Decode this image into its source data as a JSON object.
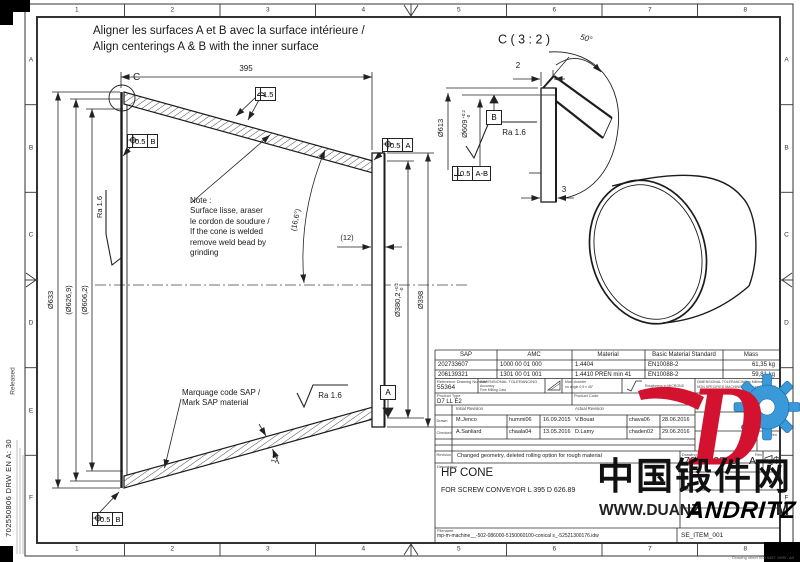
{
  "sheet": {
    "cols": [
      "1",
      "2",
      "3",
      "4",
      "5",
      "6",
      "7",
      "8"
    ],
    "rows": [
      "A",
      "B",
      "C",
      "D",
      "E",
      "F"
    ],
    "released": "Released",
    "margin_id": "702550806 DRW EN A: 30",
    "std_note": "Drawing sheet ISO 5457 1999 - A3"
  },
  "instruction": {
    "line1": "Aligner les surfaces A et B avec la surface intérieure /",
    "line2": "Align centerings A & B with the inner surface"
  },
  "main_view": {
    "length": "395",
    "detail_mark": "C",
    "dia_outer": "Ø633",
    "dia_mid": "(Ø626,9)",
    "dia_inner": "(Ø606,2)",
    "dia_small": "Ø380,2",
    "dia_small_tol_up": "+0.2",
    "dia_small_tol_dn": "-0",
    "dia_small_outer": "Ø398",
    "wall": "(12)",
    "wall_thk": "12",
    "angle": "(16,6°)",
    "ra": "Ra 1.6",
    "profile_tol": "1.5",
    "pos_tol_b": "0.5",
    "datum_b": "B",
    "pos_tol_a": "0.5",
    "datum_a": "A",
    "note": [
      "Note :",
      "Surface lisse, araser",
      "le cordon de soudure /",
      "If the cone is welded",
      "remove weld bead by",
      "grinding"
    ],
    "mark": [
      "Marquage code SAP /",
      "Mark SAP material"
    ]
  },
  "detail_view": {
    "title": "C ( 3 : 2 )",
    "angle": "50°",
    "chamfer": "2",
    "thk": "3",
    "dia1": "Ø613",
    "dia2": "Ø609",
    "dia2_tol_up": "+0.2",
    "dia2_tol_dn": "-0",
    "ra": "Ra 1.6",
    "datum": "B",
    "perp_tol": "0.5",
    "perp_datum": "A-B"
  },
  "title_block": {
    "headers": [
      "SAP",
      "AMC",
      "Material",
      "Basic Material Standard",
      "Mass"
    ],
    "rows": [
      {
        "sap": "202733607",
        "amc": "1000 00 01 000",
        "material": "1.4404",
        "standard": "EN10088-2",
        "mass": "61,35 kg"
      },
      {
        "sap": "206139321",
        "amc": "1301 00 01 001",
        "material": "1.4410 PREN min 41",
        "standard": "EN10088-2",
        "mass": "59,81 kg"
      }
    ],
    "ref_label": "Reference Drawing Number",
    "ref_value": "55364",
    "tol_label": "DIMENSIONAL TOLERANCING",
    "tol_sub1": "Accuracy",
    "tol_sub2": "Fine Milling Cast",
    "chamfer1": "Max. chamfer",
    "chamfer2": "on angle 0,5 x 45°",
    "rough_note": "Roughness in MICRONS",
    "right_note1": "DIMENSIONAL TOLERANCING in Millimeters",
    "right_note2": "NON SPECIFIED MACHININGS : roughness = 3,2",
    "product_type_label": "Product Type",
    "product_type": "D7 LL E2",
    "product_code_label": "Product Code",
    "initial_rev_label": "Initial Revision",
    "actual_rev_label": "Actual Revision",
    "drawn_label": "Drawn",
    "checked_label": "Checked",
    "drawn": {
      "name": "M.Jenco",
      "id": "hummi06",
      "date": "16.09.2015"
    },
    "checked": {
      "name": "A.Sanliard",
      "id": "chaala04",
      "date": "13.05.2016"
    },
    "actual_drawn": {
      "name": "V.Bouat",
      "id": "chava06",
      "date": "28.06.2016"
    },
    "actual_checked": {
      "name": "D.Lamy",
      "id": "chaden02",
      "date": "29.06.2016"
    },
    "rev_col_label": "Rev",
    "revision_label": "Revision",
    "revision_text": "Changed geometry, deleted rolling option for rough material",
    "description_label": "Description",
    "title": "HP CONE",
    "subtitle": "FOR SCREW CONVEYOR L 395 D 626.89",
    "drawing_no_label": "Drawing No",
    "drawing_no": "702550806",
    "rev_label": "Rev",
    "rev": "A",
    "filename_label": "Filename",
    "filename": "mp-m-machine__-502-086000-5150060100-conical s_-52521300176.idw",
    "item": "SE_ITEM_001"
  },
  "watermark": {
    "cjk": "中国锻件网",
    "url_left": "WWW.DUANZ",
    "url_right": "M",
    "brand": "ANDRITZ",
    "red": "#d2122e",
    "blue": "#3a9ad9"
  }
}
